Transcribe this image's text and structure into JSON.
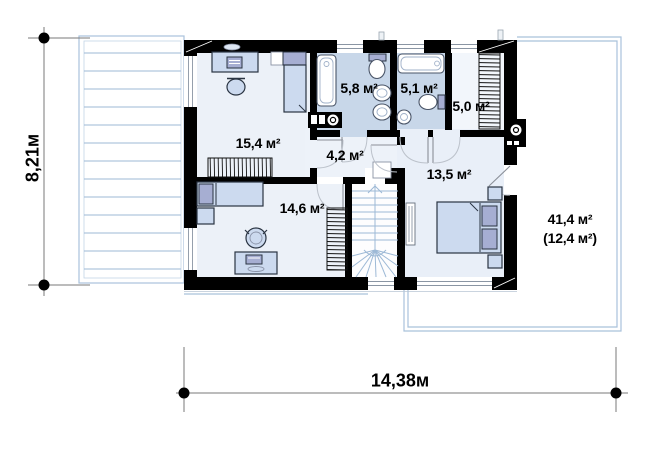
{
  "colors": {
    "wall": "#000000",
    "floor_light": "#ecf1f8",
    "floor_bath": "#c8d7e9",
    "floor_hall": "#edf2f9",
    "furniture_fill": "#ccdaef",
    "furniture_accent": "#a6aed2",
    "plan_line_blue": "#9db9d6",
    "outline_blue": "#a9c2db",
    "dimension_gray": "#7a7a7a",
    "text": "#000000"
  },
  "dimensions": {
    "vertical_label": "8,21м",
    "horizontal_label": "14,38м"
  },
  "rooms": [
    {
      "key": "study",
      "label": "15,4 м²"
    },
    {
      "key": "bathroom-1",
      "label": "5,8 м²"
    },
    {
      "key": "bathroom-2",
      "label": "5,1 м²"
    },
    {
      "key": "wardrobe",
      "label": "5,0 м²"
    },
    {
      "key": "hall",
      "label": "4,2 м²"
    },
    {
      "key": "bedroom-1",
      "label": "13,5 м²"
    },
    {
      "key": "bedroom-2",
      "label": "14,6 м²"
    },
    {
      "key": "balcony",
      "label": "41,4 м²"
    },
    {
      "key": "balcony-net",
      "label": "(12,4 м²)"
    }
  ]
}
